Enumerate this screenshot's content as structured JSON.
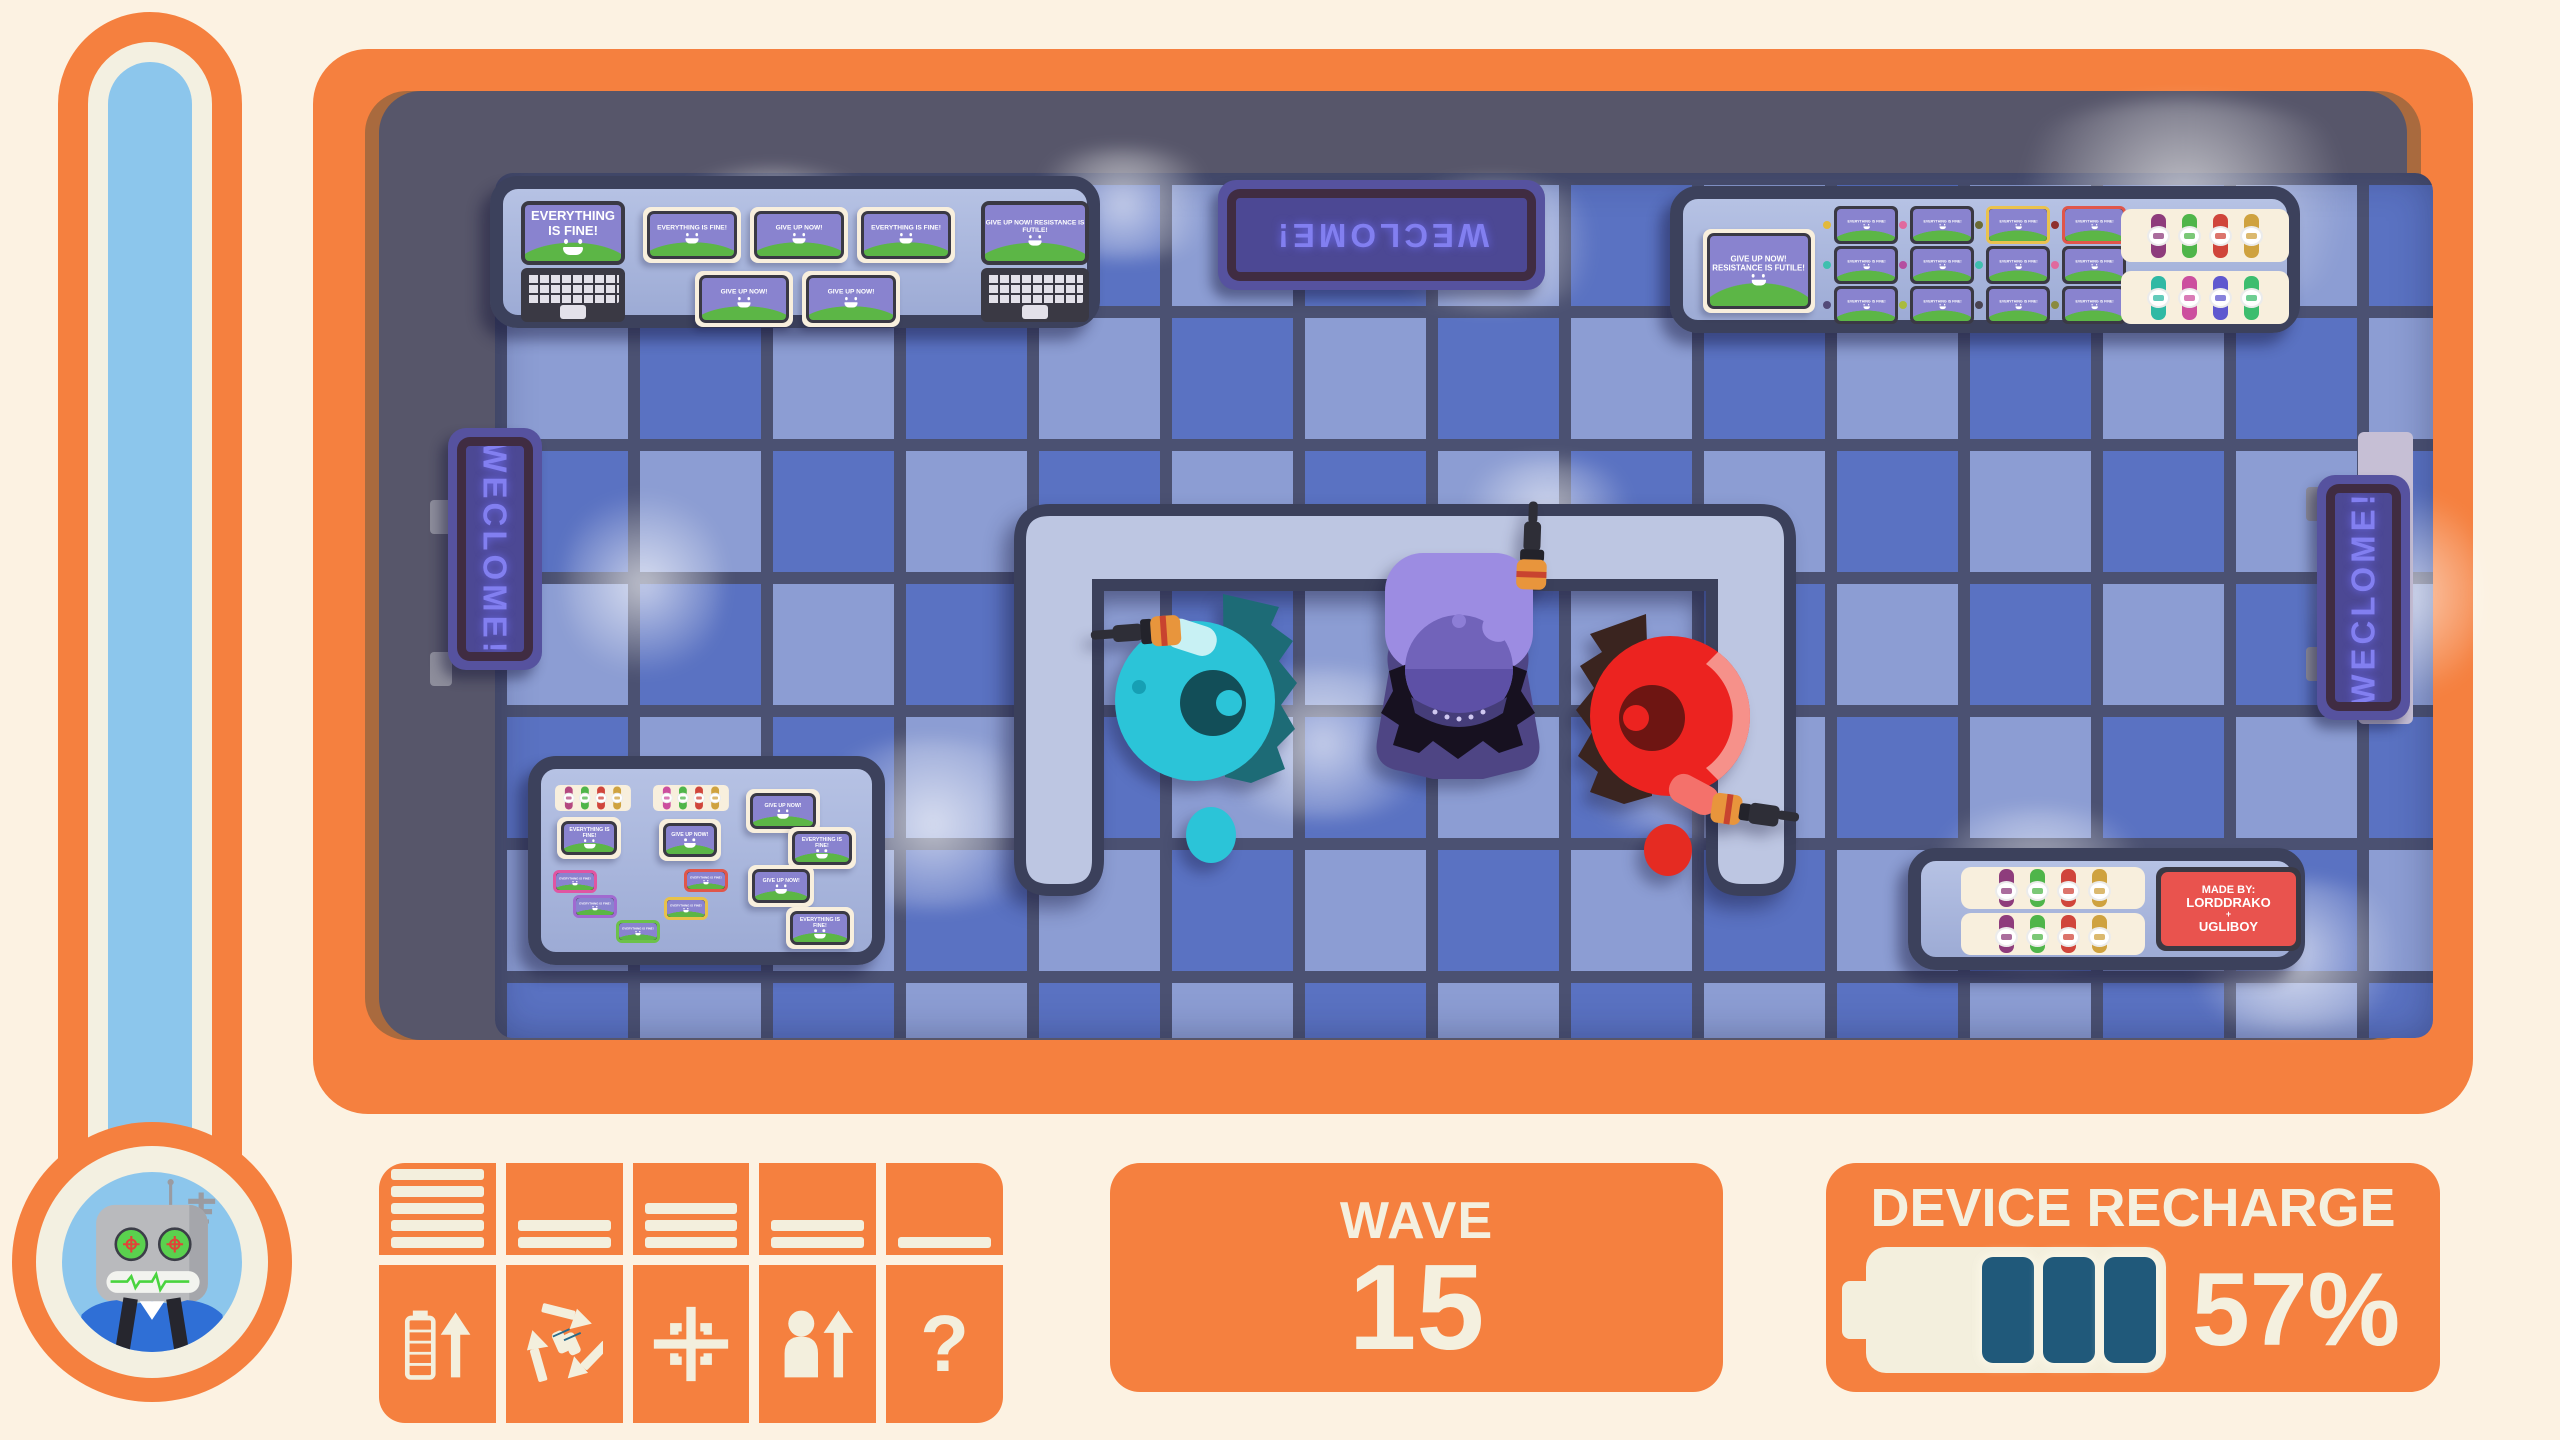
{
  "thermometer": {
    "fill_percent": 100
  },
  "room": {
    "signs": {
      "top": "WECLOME!",
      "left": "WECLOME!",
      "right": "WECLOME!"
    },
    "shelf_top_left": {
      "laptop_left": {
        "text": "EVERYTHING IS FINE!"
      },
      "tablets_row1": [
        {
          "text": "EVERYTHING IS FINE!"
        },
        {
          "text": "GIVE UP NOW!"
        },
        {
          "text": "EVERYTHING IS FINE!"
        }
      ],
      "tablets_row2": [
        {
          "text": "GIVE UP NOW!"
        },
        {
          "text": "GIVE UP NOW!"
        }
      ],
      "laptop_right": {
        "text": "GIVE UP NOW! RESISTANCE IS FUTILE!"
      }
    },
    "shelf_top_right": {
      "tablet": {
        "text": "GIVE UP NOW! RESISTANCE IS FUTILE!"
      },
      "phones": [
        {
          "text": "EVERYTHING IS FINE!",
          "dot": "#e2b93b",
          "frame": "#3a3944"
        },
        {
          "text": "EVERYTHING IS FINE!",
          "dot": "#e06a9e",
          "frame": "#3a3944"
        },
        {
          "text": "EVERYTHING IS FINE!",
          "dot": "#6b6b35",
          "frame": "#eac24d"
        },
        {
          "text": "EVERYTHING IS FINE!",
          "dot": "#8f2f2f",
          "frame": "#e0564a"
        },
        {
          "text": "EVERYTHING IS FINE!",
          "dot": "#3fbfae",
          "frame": "#3a3944"
        },
        {
          "text": "EVERYTHING IS FINE!",
          "dot": "#b44fa0",
          "frame": "#3a3944"
        },
        {
          "text": "EVERYTHING IS FINE!",
          "dot": "#3fbfae",
          "frame": "#3a3944"
        },
        {
          "text": "EVERYTHING IS FINE!",
          "dot": "#e06a9e",
          "frame": "#3a3944"
        },
        {
          "text": "EVERYTHING IS FINE!",
          "dot": "#534a78",
          "frame": "#3a3944"
        },
        {
          "text": "EVERYTHING IS FINE!",
          "dot": "#a9bb3e",
          "frame": "#3a3944"
        },
        {
          "text": "EVERYTHING IS FINE!",
          "dot": "#4a4452",
          "frame": "#3a3944"
        },
        {
          "text": "EVERYTHING IS FINE!",
          "dot": "#8a8a3f",
          "frame": "#3a3944"
        }
      ],
      "watch_tray_top": [
        "#8e3c7c",
        "#4fb54a",
        "#d0453b",
        "#cfa23f"
      ],
      "watch_tray_bottom": [
        "#2fb9a4",
        "#cc4f9e",
        "#5f58cf",
        "#3dbd6e"
      ]
    },
    "shelf_bottom_left": {
      "watch_tray_1": [
        "#b4487f",
        "#4fb54a",
        "#d0453b",
        "#cfa23f"
      ],
      "watch_tray_2": [
        "#cc4f9e",
        "#4fb54a",
        "#d0453b",
        "#cfa23f"
      ],
      "tablets": [
        {
          "text": "GIVE UP NOW!"
        },
        {
          "text": "EVERYTHING IS FINE!"
        },
        {
          "text": "GIVE UP NOW!"
        },
        {
          "text": "EVERYTHING IS FINE!"
        },
        {
          "text": "GIVE UP NOW!"
        },
        {
          "text": "EVERYTHING IS FINE!"
        }
      ],
      "phones": [
        {
          "text": "EVERYTHING IS FINE!",
          "frame": "#e055a2"
        },
        {
          "text": "EVERYTHING IS FINE!",
          "frame": "#a06ad0"
        },
        {
          "text": "EVERYTHING IS FINE!",
          "frame": "#6cc24a"
        },
        {
          "text": "EVERYTHING IS FINE!",
          "frame": "#e0564a"
        },
        {
          "text": "EVERYTHING IS FINE!",
          "frame": "#e8c24a"
        }
      ]
    },
    "shelf_bottom_right": {
      "watch_tray_1": [
        "#8e3c7c",
        "#4fb54a",
        "#d0453b",
        "#cfa23f"
      ],
      "watch_tray_2": [
        "#8e3c7c",
        "#4fb54a",
        "#d0453b",
        "#cfa23f"
      ],
      "credit_sign": {
        "line1": "MADE BY:",
        "line2": "LORDDRAKO",
        "line3": "+",
        "line4": "UGLIBOY"
      }
    },
    "characters": [
      {
        "id": "teal-technician",
        "color": "#2bc4d8"
      },
      {
        "id": "purple-technician",
        "color": "#7163ba"
      },
      {
        "id": "red-technician",
        "color": "#ec2320"
      }
    ]
  },
  "hud": {
    "upgrades": [
      {
        "icon": "battery-upgrade-icon",
        "level": 5
      },
      {
        "icon": "recycle-icon",
        "level": 2
      },
      {
        "icon": "crosshair-icon",
        "level": 3
      },
      {
        "icon": "person-upgrade-icon",
        "level": 2
      },
      {
        "icon": "question-icon",
        "level": 1,
        "glyph": "?"
      }
    ],
    "wave": {
      "label": "WAVE",
      "value": "15"
    },
    "recharge": {
      "label": "DEVICE RECHARGE",
      "value": "57%",
      "battery_segments": 3
    }
  },
  "colors": {
    "accent_orange": "#f5803f",
    "cream": "#f3efdd",
    "battery_teal": "#20597a",
    "neon_sign": "#827ff0",
    "floor_dark": "#5a72c2",
    "floor_light": "#8c9dd3"
  }
}
